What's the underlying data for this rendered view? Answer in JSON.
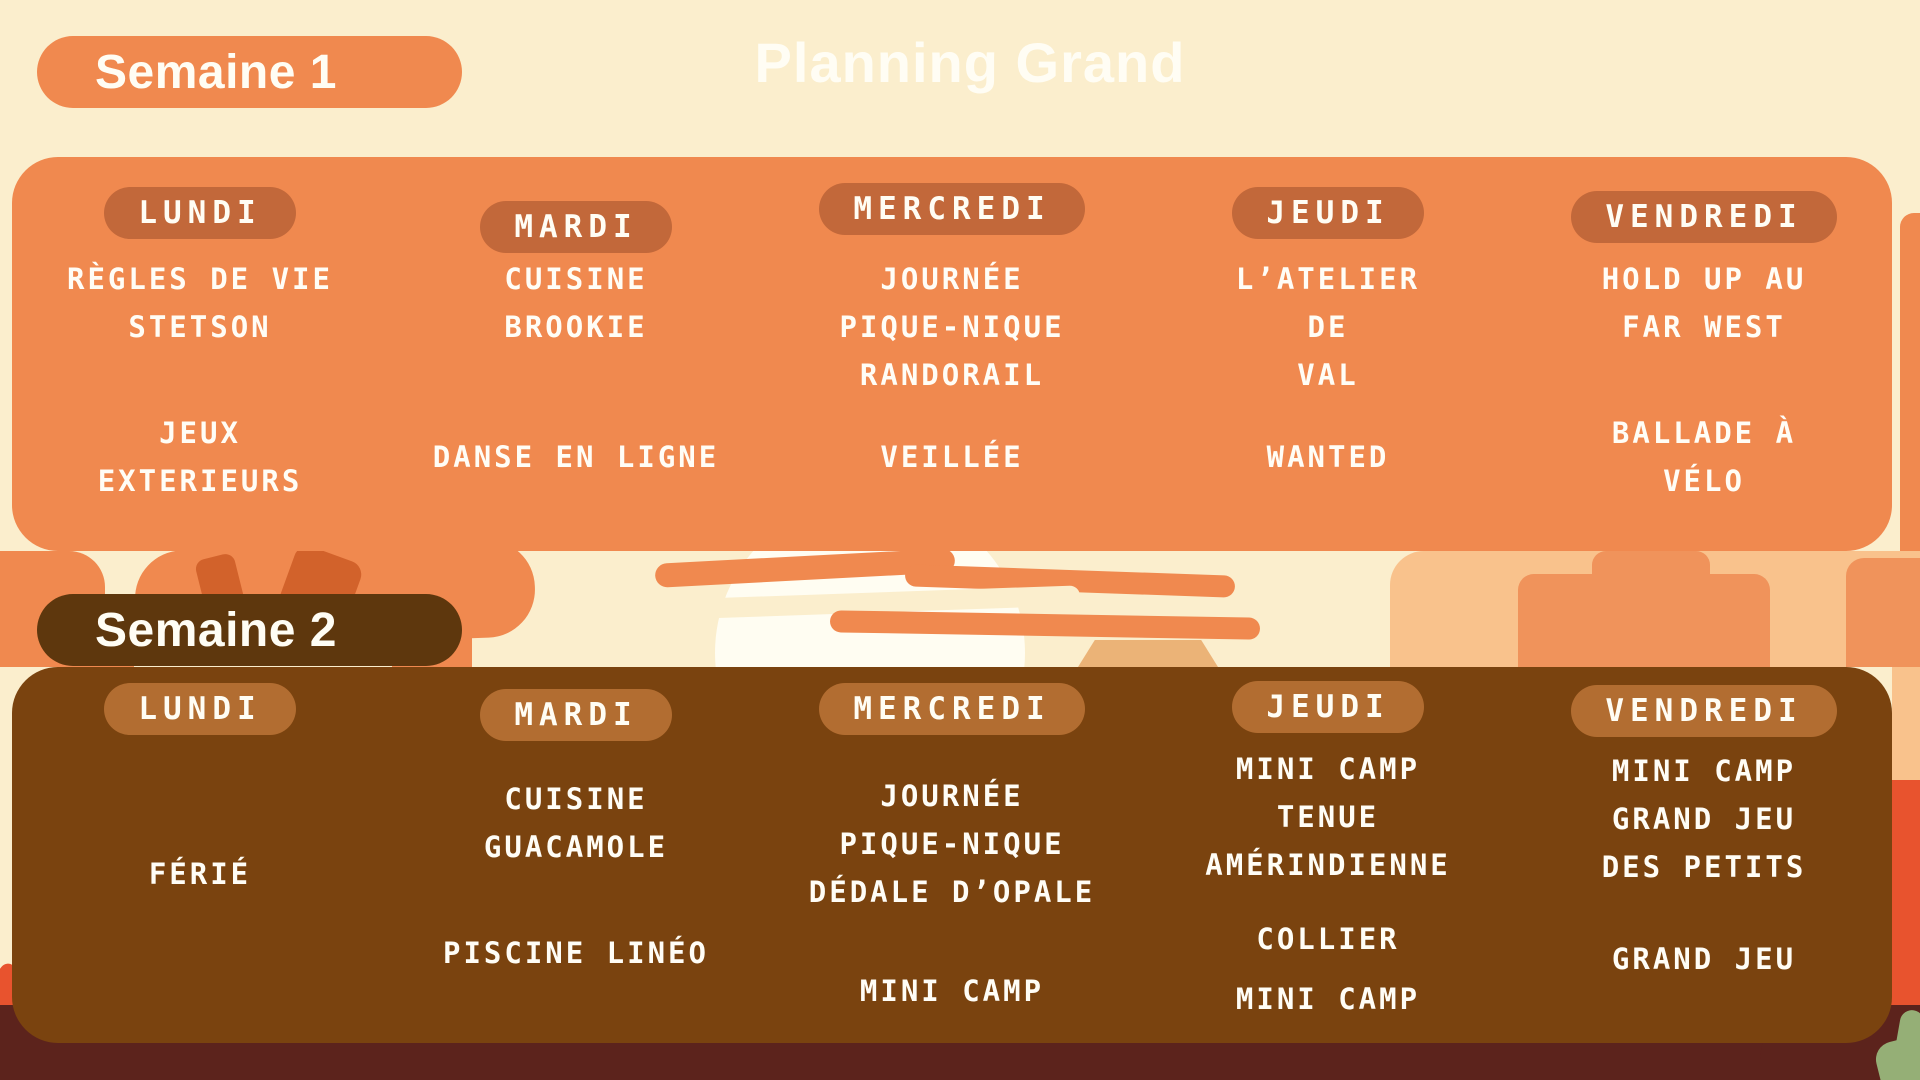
{
  "page": {
    "title": "Planning Grand"
  },
  "palette": {
    "background_cream": "#FBEECD",
    "week1_panel_orange": "#F0894F",
    "week1_day_badge": "#C2683A",
    "week2_panel_brown": "#7A430F",
    "week2_day_badge": "#B26D31",
    "week2_title_badge": "#5E370D",
    "text_white": "#FFFDF4",
    "ground_maroon": "#5C231C",
    "rock_red": "#E8532E",
    "rock_light": "#F9C28C",
    "rock_mid": "#F0935B",
    "cactus_green": "#95AF76"
  },
  "weeks": [
    {
      "label": "Semaine 1",
      "days": [
        {
          "name": "LUNDI",
          "activities": [
            "RÈGLES DE VIE\nSTETSON",
            "JEUX\nEXTERIEURS"
          ]
        },
        {
          "name": "MARDI",
          "activities": [
            "CUISINE\nBROOKIE",
            "DANSE EN LIGNE"
          ]
        },
        {
          "name": "MERCREDI",
          "activities": [
            "JOURNÉE\nPIQUE-NIQUE\nRANDORAIL",
            "VEILLÉE"
          ]
        },
        {
          "name": "JEUDI",
          "activities": [
            "L’ATELIER\nDE\nVAL",
            "WANTED"
          ]
        },
        {
          "name": "VENDREDI",
          "activities": [
            "HOLD UP AU\nFAR WEST",
            "BALLADE À\nVÉLO"
          ]
        }
      ]
    },
    {
      "label": "Semaine 2",
      "days": [
        {
          "name": "LUNDI",
          "activities": [
            "FÉRIÉ"
          ]
        },
        {
          "name": "MARDI",
          "activities": [
            "CUISINE\nGUACAMOLE",
            "PISCINE LINÉO"
          ]
        },
        {
          "name": "MERCREDI",
          "activities": [
            "JOURNÉE\nPIQUE-NIQUE\nDÉDALE D’OPALE",
            "MINI CAMP"
          ]
        },
        {
          "name": "JEUDI",
          "activities": [
            "MINI CAMP\nTENUE\nAMÉRINDIENNE",
            "COLLIER",
            "MINI CAMP"
          ]
        },
        {
          "name": "VENDREDI",
          "activities": [
            "MINI CAMP\nGRAND JEU\nDES PETITS",
            "GRAND JEU"
          ]
        }
      ]
    }
  ]
}
